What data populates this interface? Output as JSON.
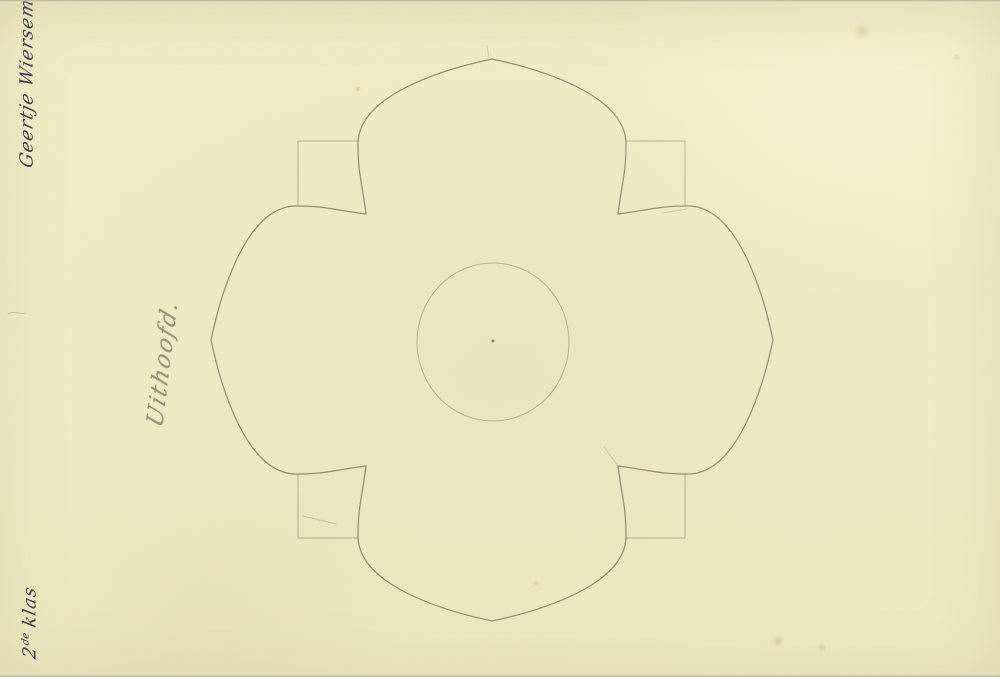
{
  "document": {
    "kind": "scanned pencil drawing on cream paper",
    "inscriptions": {
      "signature": "Geertje Wiersema",
      "subject": "Uithoofd.",
      "class_number": "2",
      "class_ordinal": "de",
      "class_word": "klas"
    }
  },
  "palette": {
    "paper": "#f2ecc3",
    "paper_edge": "#c9c5b6",
    "ink": "#433e58",
    "pencil_dark": "#6f6b5b",
    "pencil_light": "#8b8775"
  },
  "drawing": {
    "description": "Quatrefoil rosette of four pointed ogee petals centred on a light construction square, with a plain circle and compass centre point in the middle",
    "rosette_path": "M366,214 C362,182 358,174 358,144 C358,96 440,70 492,59 C544,70 626,96 626,144 C626,174 622,182 618,214 C650,210 658,206 688,206 C736,206 762,288 773,340 C762,392 736,474 688,474 C658,474 650,470 618,466 C622,498 626,506 626,536 C626,584 544,610 492,621 C440,610 358,584 358,536 C358,506 362,498 366,466 C334,470 326,474 296,474 C248,474 222,392 211,340 C222,288 248,206 296,206 C326,206 334,210 366,214 Z",
    "square_path": "M298,141 L685,141 L685,538 L298,538 Z",
    "circle_path": "M417,342 a76,79 0 1,0 152,0 a76,79 0 1,0 -152,0",
    "center_dot_path": "M491.5,341 a1.5,1.5 0 1,0 3,0 a1.5,1.5 0 1,0 -3,0",
    "stray_marks_path": "M489,57 L487,46 M618,466 L604,447 M303,516 L336,524 M663,213 L687,209 M8,314 C13,310 19,315 26,313"
  }
}
